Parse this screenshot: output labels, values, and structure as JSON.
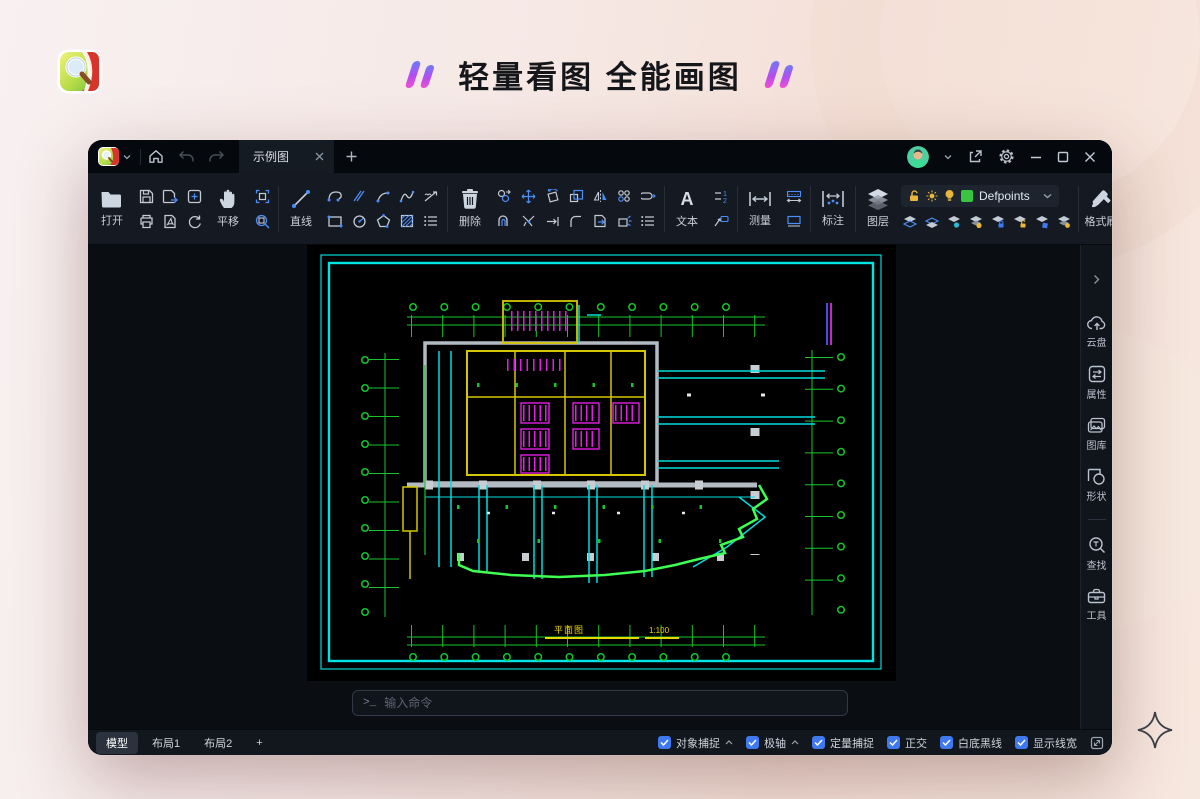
{
  "page": {
    "hero_title": "轻量看图 全能画图"
  },
  "titlebar": {
    "tab_title": "示例图"
  },
  "toolbar": {
    "open_label": "打开",
    "pan_label": "平移",
    "line_label": "直线",
    "erase_label": "删除",
    "text_label": "文本",
    "measure_label": "测量",
    "annotate_label": "标注",
    "layer_label": "图层",
    "layer_dropdown_value": "Defpoints",
    "format_brush_label": "格式刷",
    "color_label": "颜色",
    "linetype_label": "线型"
  },
  "sidebar": {
    "items": [
      {
        "label": "云盘"
      },
      {
        "label": "属性"
      },
      {
        "label": "图库"
      },
      {
        "label": "形状"
      },
      {
        "label": "查找"
      },
      {
        "label": "工具"
      }
    ]
  },
  "command": {
    "prompt": ">_",
    "placeholder": "输入命令"
  },
  "statusbar": {
    "tabs": [
      {
        "label": "模型"
      },
      {
        "label": "布局1"
      },
      {
        "label": "布局2"
      }
    ],
    "add_layout_label": "+",
    "toggles": [
      {
        "label": "对象捕捉",
        "checked": true,
        "chevron": true
      },
      {
        "label": "极轴",
        "checked": true,
        "chevron": true
      },
      {
        "label": "定量捕捉",
        "checked": true
      },
      {
        "label": "正交",
        "checked": true
      },
      {
        "label": "白底黑线",
        "checked": true
      },
      {
        "label": "显示线宽",
        "checked": true
      }
    ]
  },
  "drawing": {
    "caption": "平面图",
    "scale": "1:100"
  },
  "colors": {
    "accent_blue": "#4d8df6",
    "cad_cyan": "#00dede",
    "cad_green": "#17c42c",
    "cad_bright_green": "#3fff52",
    "cad_magenta": "#e31ee3",
    "cad_yellow": "#d6c600",
    "defpoints_swatch": "#39c53f",
    "checkbox_blue": "#3e79f0"
  }
}
